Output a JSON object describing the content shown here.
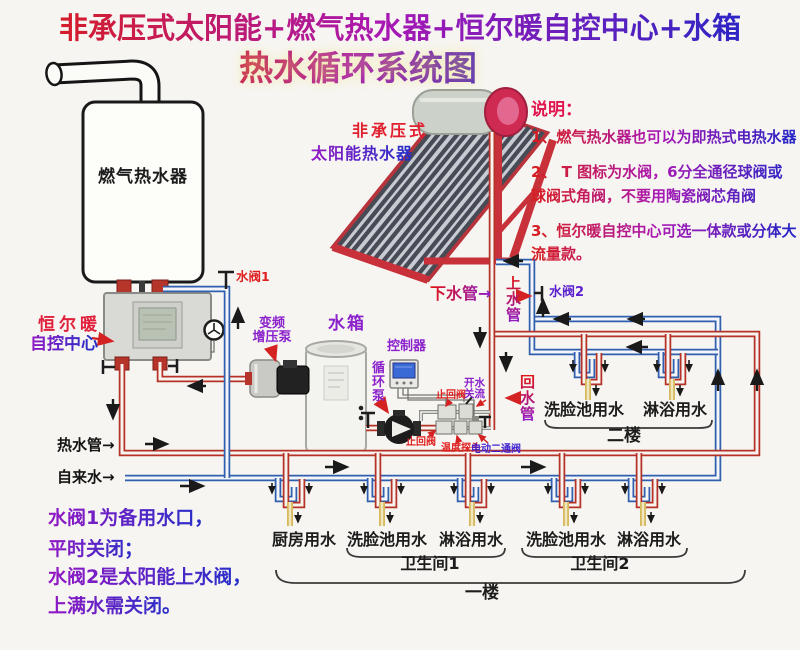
{
  "title": {
    "line1": "非承压式太阳能+燃气热水器+恒尔暖自控中心+水箱",
    "line2": "热水循环系统图"
  },
  "notes": {
    "heading": "说明：",
    "item1": "1、燃气热水器也可以为即热式电热水器",
    "item2": "2、 T 图标为水阀，6分全通径球阀或球阀式角阀，不要用陶瓷阀芯角阀",
    "item3": "3、恒尔暖自控中心可选一体款或分体大流量款。"
  },
  "devices": {
    "gas_heater": "燃气热水器",
    "solar_line1": "非承压式",
    "solar_line2": "太阳能热水器",
    "control_center_line1": "恒尔暖",
    "control_center_line2": "自控中心",
    "booster_line1": "变频",
    "booster_line2": "增压泵",
    "tank": "水箱",
    "controller": "控制器",
    "circulation_pump": "循环泵"
  },
  "pipes": {
    "valve1": "水阀1",
    "valve2": "水阀2",
    "down_pipe": "下水管→",
    "up_pipe": "上水管",
    "return_pipe": "回水管",
    "hot_pipe": "热水管→",
    "tap_water": "自来水→",
    "check_valve_top": "止回阀",
    "check_valve_bottom": "止回阀",
    "open_line1": "开水",
    "open_line2": "关流",
    "temp_probe": "温度探头",
    "motor_valve": "电动二通阀"
  },
  "floor2": {
    "fixture1": "洗脸池用水",
    "fixture2": "淋浴用水",
    "label": "二楼"
  },
  "floor1": {
    "fixture1": "厨房用水",
    "fixture2": "洗脸池用水",
    "fixture3": "淋浴用水",
    "fixture4": "洗脸池用水",
    "fixture5": "淋浴用水",
    "bathroom1": "卫生间1",
    "bathroom2": "卫生间2",
    "label": "一楼"
  },
  "footnotes": {
    "line1": "水阀1为备用水口，",
    "line2": "平时关闭；",
    "line3": "水阀2是太阳能上水阀，",
    "line4": "上满水需关闭。"
  },
  "colors": {
    "hot_pipe": "#b63226",
    "cold_pipe": "#2f5fae",
    "label_purple": "#8b22cc",
    "label_red": "#e02020",
    "tap_yellow": "#d6b95c"
  }
}
